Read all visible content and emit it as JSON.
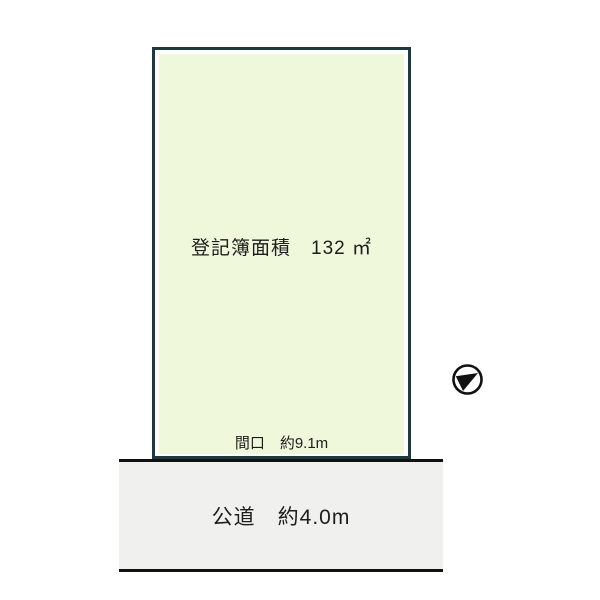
{
  "diagram": {
    "plot": {
      "area_label": "登記簿面積　132 ㎡",
      "frontage_label": "間口　約9.1m"
    },
    "road": {
      "label": "公道　約4.0m"
    },
    "compass_icon": "north-arrow",
    "colors": {
      "background": "#ffffff",
      "plot_fill": "#f0f8dc",
      "plot_border": "#20393f",
      "road_fill": "#f0f0ee",
      "road_border": "#111111",
      "text": "#1d1d1d"
    }
  }
}
